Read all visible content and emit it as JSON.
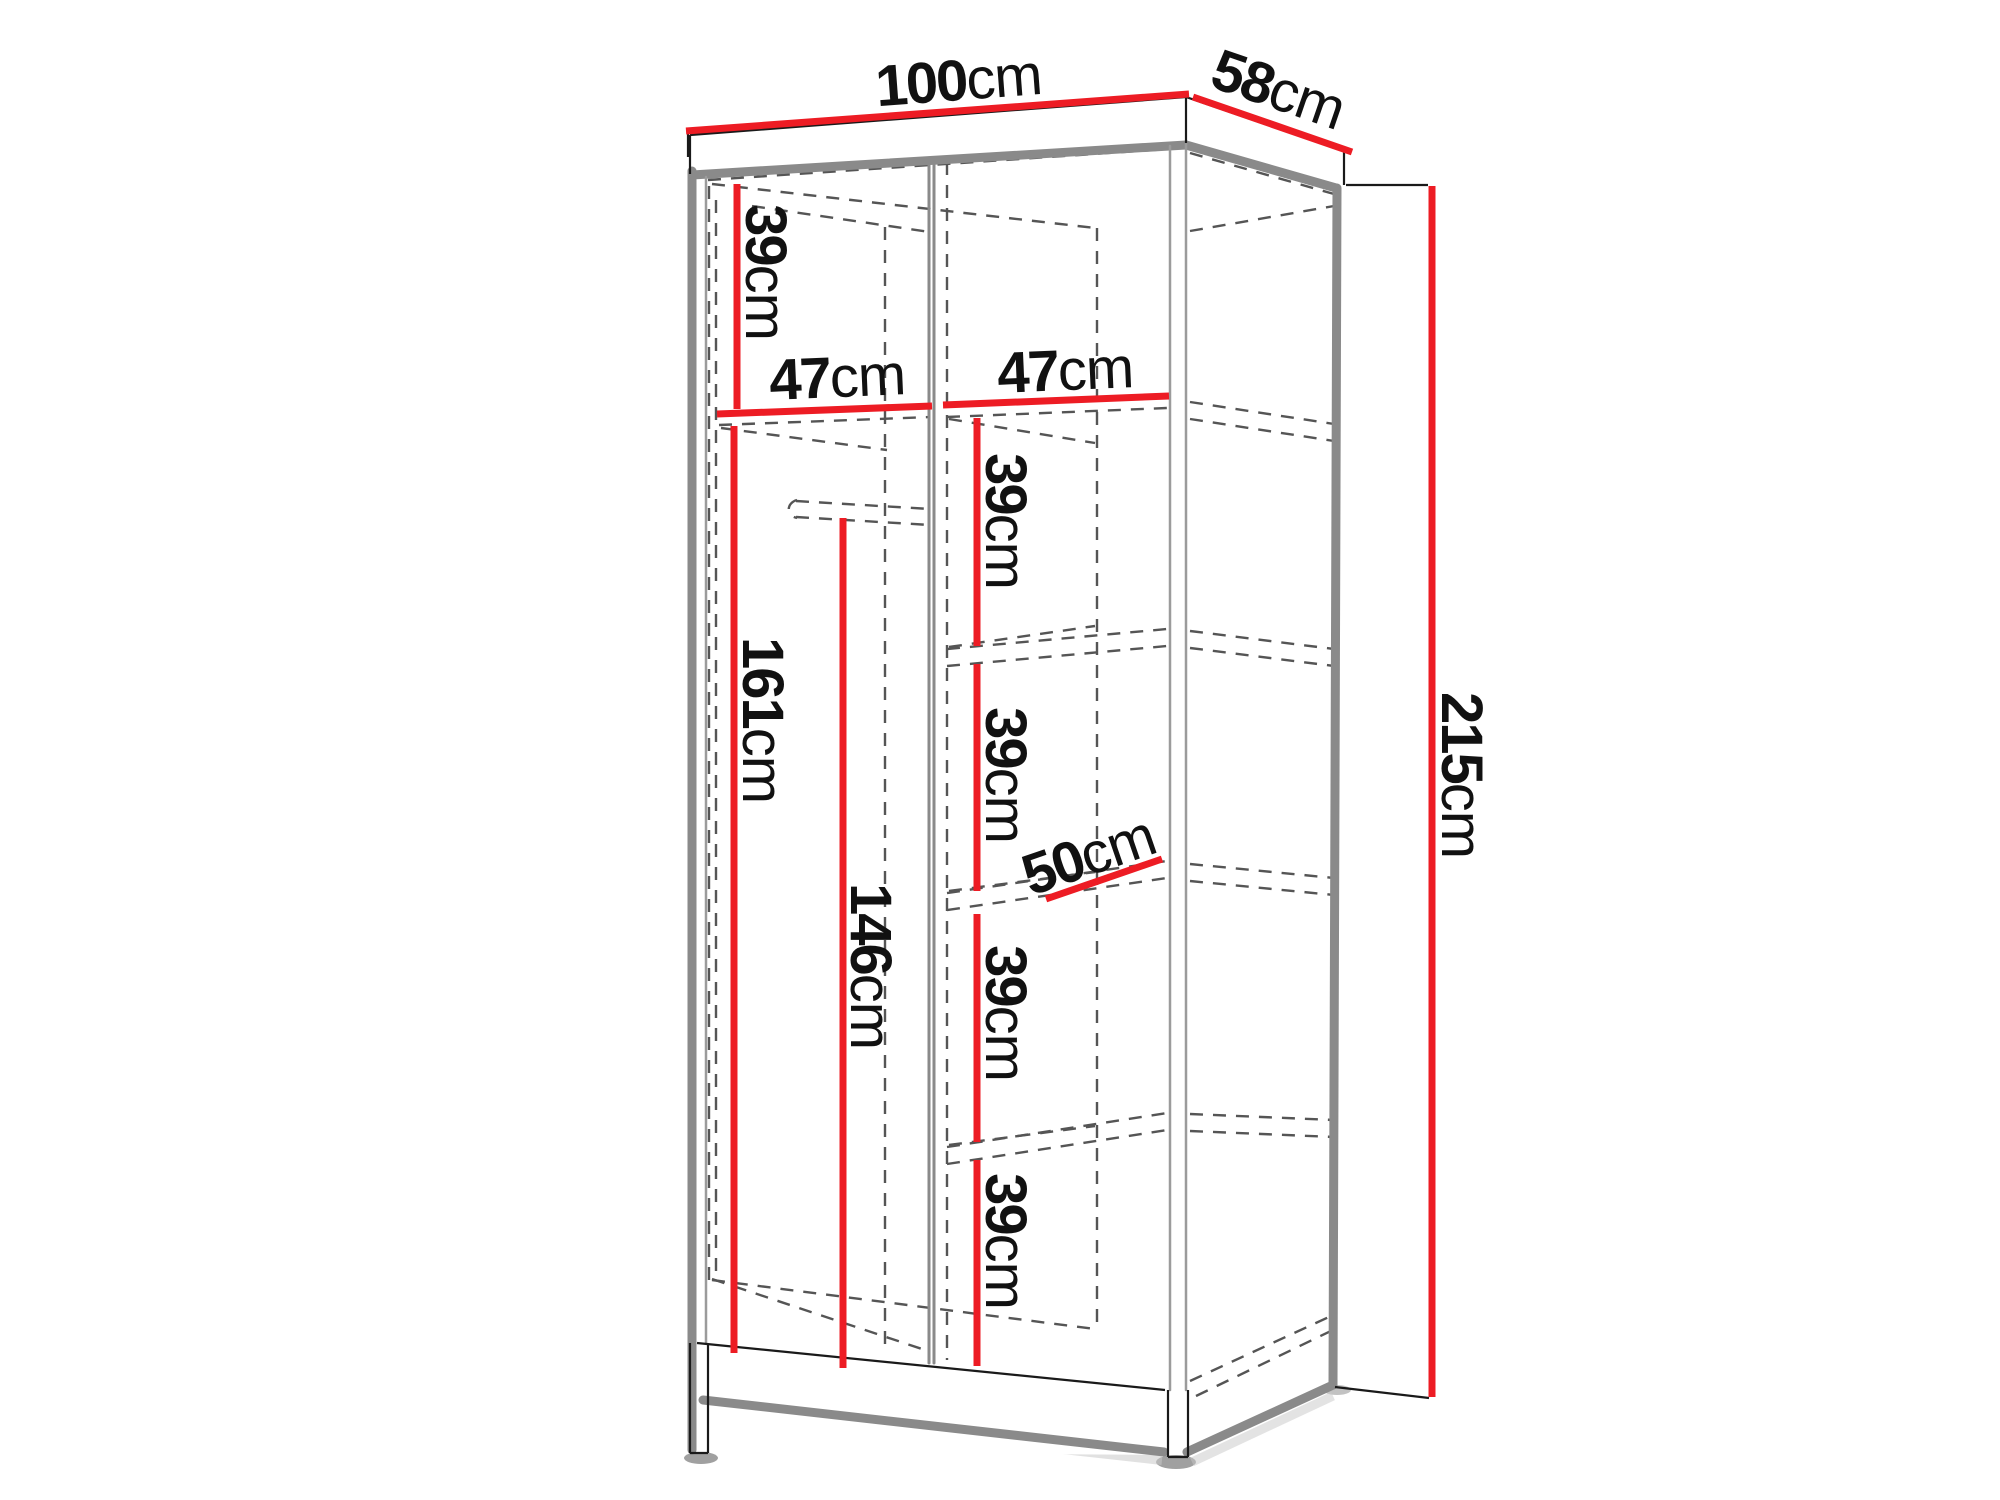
{
  "diagram": {
    "type": "wardrobe-dimension-drawing",
    "unit": "cm",
    "colors": {
      "dimension_line": "#ed1c24",
      "edge_gray": "#8a8a8a",
      "outline_black": "#1a1a1a",
      "hidden_line": "#555555",
      "label_text": "#111111",
      "background": "#ffffff"
    },
    "labels": {
      "width": {
        "value": "100",
        "unit": "cm"
      },
      "depth": {
        "value": "58",
        "unit": "cm"
      },
      "height": {
        "value": "215",
        "unit": "cm"
      },
      "top_section_height": {
        "value": "39",
        "unit": "cm"
      },
      "left_compartment_width": {
        "value": "47",
        "unit": "cm"
      },
      "right_compartment_width": {
        "value": "47",
        "unit": "cm"
      },
      "hanging_space_height": {
        "value": "161",
        "unit": "cm"
      },
      "rail_clearance_height": {
        "value": "146",
        "unit": "cm"
      },
      "shelf_gap_1": {
        "value": "39",
        "unit": "cm"
      },
      "shelf_gap_2": {
        "value": "39",
        "unit": "cm"
      },
      "shelf_gap_3": {
        "value": "39",
        "unit": "cm"
      },
      "shelf_gap_4": {
        "value": "39",
        "unit": "cm"
      },
      "shelf_depth": {
        "value": "50",
        "unit": "cm"
      }
    }
  }
}
